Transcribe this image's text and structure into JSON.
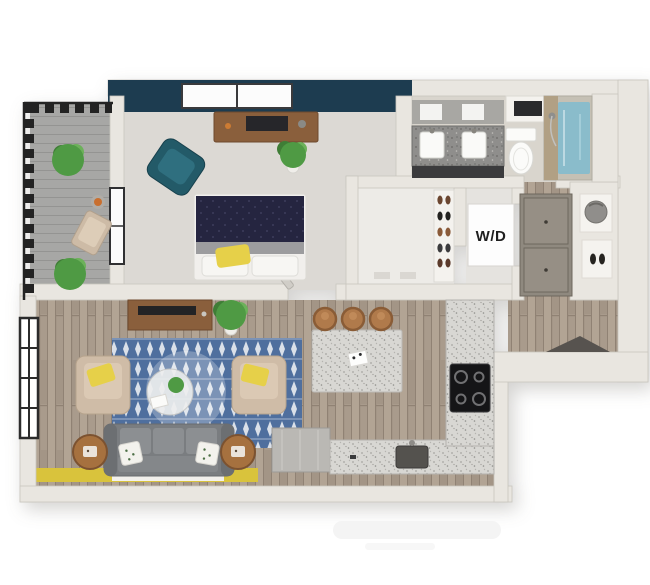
{
  "labels": {
    "washer_dryer": "W/D"
  },
  "colors": {
    "accent_wall_teal": "#1d3c50",
    "teal_chair": "#235a68",
    "rug_blue": "#4f6f9e",
    "pillow_yellow": "#e6d049",
    "floor_accent_yellow": "#d9c33c",
    "sofa_gray": "#7a7d80",
    "armchair_beige": "#cfbca7",
    "bedding_navy": "#252540",
    "plant_green": "#4f9a44",
    "wood_furniture": "#8a5f3c",
    "shower_water": "#8abccb",
    "wall_greige": "#e9e6e0",
    "wd_label_color": "#1f1f1f"
  }
}
